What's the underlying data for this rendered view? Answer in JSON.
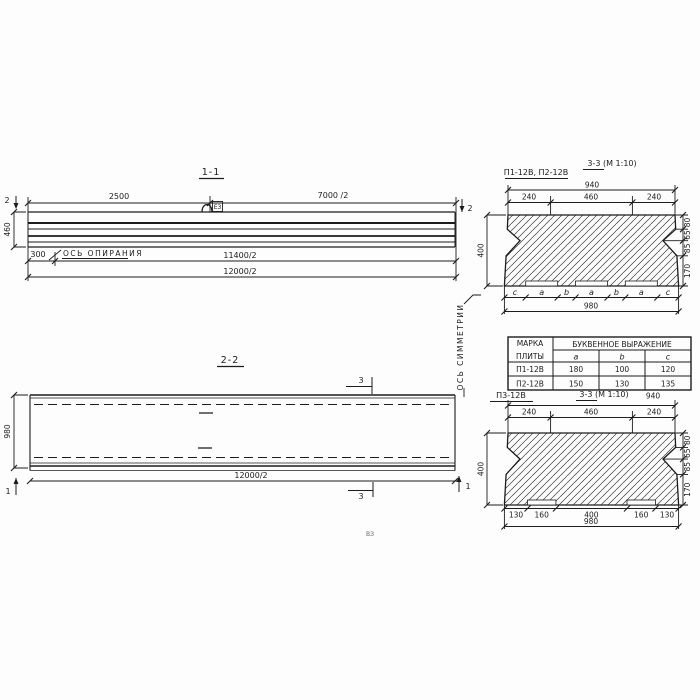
{
  "s11": {
    "title": "1-1",
    "marker2": "2",
    "dim_2500": "2500",
    "dim_7000": "7000 /2",
    "dim_height": "460",
    "dim_300": "300",
    "axis_support": "ОСЬ ОПИРАНИЯ",
    "dim_11400": "11400/2",
    "dim_12000": "12000/2",
    "hook_label": "Е3"
  },
  "s22": {
    "title": "2-2",
    "dim_height": "980",
    "dim_length": "12000/2",
    "marker3": "3",
    "marker1": "1",
    "axis_symmetry": "ОСЬ СИММЕТРИИ"
  },
  "s33a": {
    "label": "П1-12В, П2-12В",
    "title": "3-3 (М 1:10)",
    "dim_940": "940",
    "dim_240a": "240",
    "dim_460": "460",
    "dim_240b": "240",
    "dim_400": "400",
    "right_dims": [
      "80",
      "65",
      "85",
      "170"
    ],
    "letters": [
      "c",
      "a",
      "b",
      "a",
      "b",
      "a",
      "c"
    ],
    "dim_980": "980"
  },
  "table": {
    "header_col1_line1": "МАРКА",
    "header_col1_line2": "ПЛИТЫ",
    "header_span": "БУКВЕННОЕ  ВЫРАЖЕНИЕ",
    "col_a": "a",
    "col_b": "b",
    "col_c": "c",
    "rows": [
      {
        "mark": "П1-12В",
        "a": "180",
        "b": "100",
        "c": "120"
      },
      {
        "mark": "П2-12В",
        "a": "150",
        "b": "130",
        "c": "135"
      }
    ]
  },
  "s33b": {
    "label": "П3-12В",
    "title": "3-3 (М 1:10)",
    "dim_940": "940",
    "dim_240a": "240",
    "dim_460": "460",
    "dim_240b": "240",
    "dim_400": "400",
    "right_dims": [
      "80",
      "65",
      "85",
      "170"
    ],
    "bottom_dims": [
      "130",
      "160",
      "400",
      "160",
      "130"
    ],
    "dim_980": "980"
  },
  "note": "ВЗ"
}
